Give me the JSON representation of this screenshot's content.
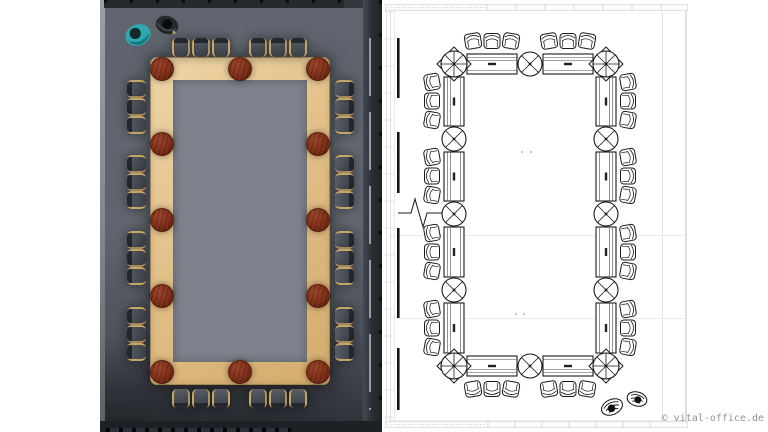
{
  "watermark": {
    "text": "© vital-office.de",
    "color": "#8e9499"
  },
  "scene": {
    "description": "Large rectangular conference ring table, 36 seats, shown as 3D top view (left) and CAD floor plan (right)",
    "seat_count": 36
  },
  "colors": {
    "floor": "#5d626c",
    "carpet": "#7d828c",
    "table_wood": "#e2c089",
    "connector_node": "#7d2f18",
    "chair_seat": "#3a3d44",
    "chair_arm_wood": "#c7a567",
    "wall": "#26292e",
    "teal_person": "#2fa7ac",
    "cad_line": "#1a1a1a",
    "cad_frame": "#d9d9d9"
  },
  "render": {
    "table": {
      "x": 50,
      "y": 57,
      "w": 180,
      "h": 328,
      "band": 23
    },
    "node_radius": 12,
    "nodes": [
      [
        62,
        69
      ],
      [
        140,
        69
      ],
      [
        218,
        69
      ],
      [
        62,
        144
      ],
      [
        218,
        144
      ],
      [
        62,
        220
      ],
      [
        218,
        220
      ],
      [
        62,
        296
      ],
      [
        218,
        296
      ],
      [
        62,
        372
      ],
      [
        140,
        372
      ],
      [
        218,
        372
      ]
    ],
    "chair_spacing_tb": 20,
    "chair_spacing_lr": 18,
    "chair_groups": [
      {
        "side": "t",
        "cx": 101,
        "cy": 47
      },
      {
        "side": "t",
        "cx": 178,
        "cy": 47
      },
      {
        "side": "b",
        "cx": 101,
        "cy": 398
      },
      {
        "side": "b",
        "cx": 178,
        "cy": 398
      },
      {
        "side": "l",
        "cx": 36,
        "cy": 107
      },
      {
        "side": "l",
        "cx": 36,
        "cy": 182
      },
      {
        "side": "l",
        "cx": 36,
        "cy": 258
      },
      {
        "side": "l",
        "cx": 36,
        "cy": 334
      },
      {
        "side": "r",
        "cx": 244,
        "cy": 107
      },
      {
        "side": "r",
        "cx": 244,
        "cy": 182
      },
      {
        "side": "r",
        "cx": 244,
        "cy": 258
      },
      {
        "side": "r",
        "cx": 244,
        "cy": 334
      }
    ],
    "people": [
      {
        "kind": "teal-person",
        "cx": 38,
        "cy": 35,
        "rot": -22
      },
      {
        "kind": "dark-person",
        "cx": 67,
        "cy": 25,
        "rot": 18
      }
    ]
  },
  "cad": {
    "band_half": 10,
    "node_radius_mid": 12,
    "node_radius_corner": 13,
    "nodes": [
      {
        "x": 454,
        "y": 64,
        "c": 1
      },
      {
        "x": 530,
        "y": 64,
        "c": 0
      },
      {
        "x": 606,
        "y": 64,
        "c": 1
      },
      {
        "x": 454,
        "y": 139,
        "c": 0
      },
      {
        "x": 606,
        "y": 139,
        "c": 0
      },
      {
        "x": 454,
        "y": 214,
        "c": 0
      },
      {
        "x": 606,
        "y": 214,
        "c": 0
      },
      {
        "x": 454,
        "y": 290,
        "c": 0
      },
      {
        "x": 606,
        "y": 290,
        "c": 0
      },
      {
        "x": 454,
        "y": 366,
        "c": 1
      },
      {
        "x": 530,
        "y": 366,
        "c": 0
      },
      {
        "x": 606,
        "y": 366,
        "c": 1
      }
    ],
    "segments": [
      {
        "o": "h",
        "x1": 454,
        "x2": 530,
        "y": 64,
        "out": -1
      },
      {
        "o": "h",
        "x1": 530,
        "x2": 606,
        "y": 64,
        "out": -1
      },
      {
        "o": "h",
        "x1": 454,
        "x2": 530,
        "y": 366,
        "out": 1
      },
      {
        "o": "h",
        "x1": 530,
        "x2": 606,
        "y": 366,
        "out": 1
      },
      {
        "o": "v",
        "y1": 64,
        "y2": 139,
        "x": 454,
        "out": -1
      },
      {
        "o": "v",
        "y1": 139,
        "y2": 214,
        "x": 454,
        "out": -1
      },
      {
        "o": "v",
        "y1": 214,
        "y2": 290,
        "x": 454,
        "out": -1
      },
      {
        "o": "v",
        "y1": 290,
        "y2": 366,
        "x": 454,
        "out": -1
      },
      {
        "o": "v",
        "y1": 64,
        "y2": 139,
        "x": 606,
        "out": 1
      },
      {
        "o": "v",
        "y1": 139,
        "y2": 214,
        "x": 606,
        "out": 1
      },
      {
        "o": "v",
        "y1": 214,
        "y2": 290,
        "x": 606,
        "out": 1
      },
      {
        "o": "v",
        "y1": 290,
        "y2": 366,
        "x": 606,
        "out": 1
      }
    ],
    "chair_spacing": 19,
    "chair_tilts": [
      -10,
      0,
      10
    ],
    "chair_groups": [
      {
        "side": "t",
        "cx": 492,
        "cy": 41
      },
      {
        "side": "t",
        "cx": 568,
        "cy": 41
      },
      {
        "side": "b",
        "cx": 492,
        "cy": 389
      },
      {
        "side": "b",
        "cx": 568,
        "cy": 389
      },
      {
        "side": "l",
        "cx": 432,
        "cy": 101
      },
      {
        "side": "l",
        "cx": 432,
        "cy": 176
      },
      {
        "side": "l",
        "cx": 432,
        "cy": 252
      },
      {
        "side": "l",
        "cx": 432,
        "cy": 328
      },
      {
        "side": "r",
        "cx": 628,
        "cy": 101
      },
      {
        "side": "r",
        "cx": 628,
        "cy": 176
      },
      {
        "side": "r",
        "cx": 628,
        "cy": 252
      },
      {
        "side": "r",
        "cx": 628,
        "cy": 328
      }
    ],
    "window_bar_x": 397,
    "window_bars": [
      [
        38,
        98
      ],
      [
        132,
        193
      ],
      [
        228,
        318
      ],
      [
        348,
        410
      ]
    ],
    "guides": [
      235.5,
      318.5
    ],
    "dots": [
      [
        522,
        152
      ],
      [
        531,
        152
      ],
      [
        516,
        314
      ],
      [
        524,
        314
      ]
    ],
    "frame": {
      "left_tick_spacing": 27,
      "top_div_start": 487,
      "top_div_end": 662,
      "top_div_step": 29,
      "bottom_div_start": 488,
      "bottom_div_end": 662,
      "bottom_div_step": 27
    }
  }
}
